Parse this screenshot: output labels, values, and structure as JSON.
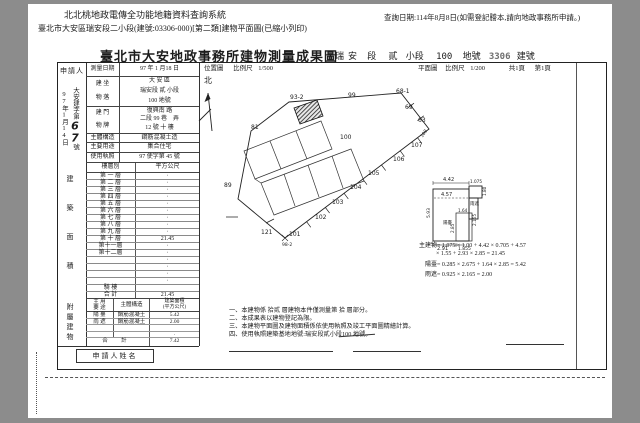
{
  "colors": {
    "background": "#8c8c8c",
    "paper": "#ffffff",
    "ink": "#1c1c1c"
  },
  "header": {
    "system_title": "北北桃地政電傳全功能地籍資料查詢系統",
    "query_date": "查詢日期:114年8月8日(如需登記謄本,請向地政事務所申請。)",
    "print_subtitle": "臺北市大安區瑞安段二小段(建號:03306-000)[第二類]建物平面圖(已縮小列印)"
  },
  "doc": {
    "title": "臺北市大安地政事務所建物測量成果圖",
    "title_right": {
      "section": "瑞安",
      "section_label": "段",
      "subsection": "貳",
      "subsection_label": "小段",
      "land_no": "100",
      "land_label": "地號",
      "building_no": "3306",
      "building_label": "建號"
    },
    "applicant": {
      "label": "申請人",
      "receipt_date": "97年1月14日",
      "receipt_prefix": "大安建字第",
      "receipt_no": "67",
      "receipt_suffix": "號"
    },
    "info": {
      "survey_date": {
        "label": "測量日期",
        "value": "97 年 1 月18 日"
      },
      "location": {
        "label_1": "建 坐",
        "label_2": "物 落",
        "line_1": "大 安 區",
        "line_2": "瑞安段 貳 小段",
        "line_3": "100 地號"
      },
      "address": {
        "label_1": "建 門",
        "label_2": "物 牌",
        "line_1": "復興南 路",
        "line_2": "二段 99 巷　弄",
        "line_3": "12 號 十 樓"
      },
      "structure": {
        "label": "主體構造",
        "value": "鋼筋混凝土造"
      },
      "usage": {
        "label": "主要用途",
        "value": "集合住宅"
      },
      "license": {
        "label": "使用執照",
        "value": "97 使字第 45 號"
      }
    },
    "floor_table": {
      "side_label": "建築面積",
      "col_floor": "樓層別",
      "col_area": "平方公尺",
      "rows": [
        {
          "floor": "第 一 層",
          "area": "·"
        },
        {
          "floor": "第 二 層",
          "area": "·"
        },
        {
          "floor": "第 三 層",
          "area": "·"
        },
        {
          "floor": "第 四 層",
          "area": "·"
        },
        {
          "floor": "第 五 層",
          "area": "·"
        },
        {
          "floor": "第 六 層",
          "area": "·"
        },
        {
          "floor": "第 七 層",
          "area": "·"
        },
        {
          "floor": "第 八 層",
          "area": "·"
        },
        {
          "floor": "第 九 層",
          "area": "·"
        },
        {
          "floor": "第 十 層",
          "area": "21.45"
        },
        {
          "floor": "第十一層",
          "area": "·"
        },
        {
          "floor": "第十二層",
          "area": "·"
        },
        {
          "floor": "",
          "area": "·"
        },
        {
          "floor": "",
          "area": "·"
        },
        {
          "floor": "",
          "area": "·"
        },
        {
          "floor": "",
          "area": "·"
        },
        {
          "floor": "騎 樓",
          "area": ""
        },
        {
          "floor": "合 計",
          "area": "21.45"
        }
      ]
    },
    "annex_table": {
      "side_label": "附屬建物",
      "col_usage_1": "主 用",
      "col_usage_2": "要 途",
      "col_structure": "主體構造",
      "col_area_1": "建築面積",
      "col_area_2": "(平方公尺)",
      "rows": [
        {
          "usage": "陽 臺",
          "structure": "鋼筋混凝土",
          "area": "5.42"
        },
        {
          "usage": "雨 遮",
          "structure": "鋼筋混凝土",
          "area": "2.00"
        },
        {
          "usage": "",
          "structure": "",
          "area": ""
        },
        {
          "usage": "",
          "structure": "",
          "area": "·"
        }
      ],
      "total_label": "合 計",
      "total_area": "7.42"
    },
    "applicant_name_label": "申請人姓名",
    "location_map": {
      "caption": "位置圖",
      "scale_label": "比例尺",
      "scale": "1/500",
      "north_label": "北",
      "lots": {
        "l93_2": "93-2",
        "l99": "99",
        "l68_1": "68-1",
        "l69": "69",
        "l63": "63",
        "l108": "108",
        "l107": "107",
        "l106": "106",
        "l105": "105",
        "l104": "104",
        "l103": "103",
        "l102": "102",
        "l101": "101",
        "l98_2": "98-2",
        "l121": "121",
        "l89": "89",
        "l81": "81",
        "l100": "100"
      }
    },
    "floor_plan": {
      "caption": "平面圖",
      "scale_label": "比例尺",
      "scale": "1/200",
      "pages": "共1頁",
      "page": "第1頁",
      "labels": {
        "balcony": "陽臺",
        "canopy": "雨遮"
      },
      "dims": {
        "d442": "4.42",
        "d457": "4.57",
        "d1075": "1.075",
        "d593": "5.93",
        "d291": "2.91",
        "d1855": "1.855",
        "d164": "1.64",
        "d285": "2.85",
        "d2165": "2.165",
        "d180": "1.80"
      }
    },
    "calculations": {
      "main_1": "主建物= 1.075 × 1.00 + 4.42 × 0.705 + 4.57",
      "main_2": "× 1.55 + 2.93 × 2.85 = 21.45",
      "balcony": "陽臺= 0.285 × 2.675 + 1.64 × 2.85 = 5.42",
      "canopy": "雨遮= 0.925 × 2.165 = 2.00"
    },
    "notes": {
      "n1": "一、本建物係 拾貳 層建物本件僅測量第 拾 層部分。",
      "n2": "二、本成果表以建物登記為限。",
      "n3": "三、本建物平面圖及建物面積係依使用執照及竣工平面圖精繪計算。",
      "n4": "四、使用執照建築基地地號:瑞安段貳小段100 地號。"
    }
  }
}
